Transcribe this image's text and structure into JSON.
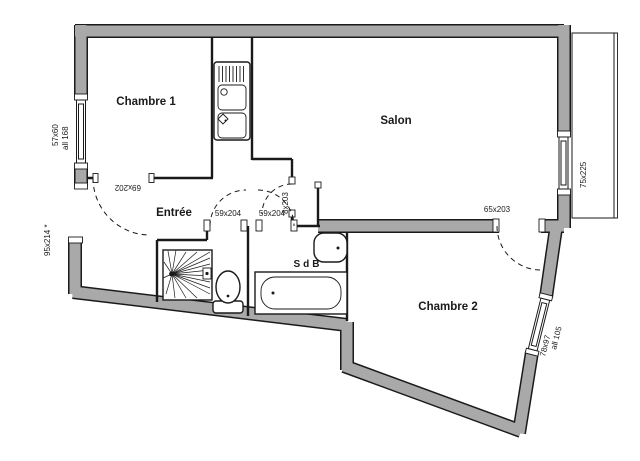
{
  "type": "floor-plan",
  "rooms": {
    "chambre1": "Chambre 1",
    "salon": "Salon",
    "entree": "Entrée",
    "sdb": "SdB",
    "chambre2": "Chambre 2"
  },
  "labels": {
    "window_ch1": "57x60",
    "window_ch1_sill": "all 168",
    "entrance_door": "95x214 *",
    "door_ch1": "69x202",
    "door_wc": "59x204",
    "door_sdb": "59x204",
    "door_salon": "8x203",
    "door_ch2": "65x203",
    "window_salon": "75x225",
    "window_ch2": "78x97",
    "window_ch2_sill": "all 105"
  },
  "fixtures": [
    "kitchen-sink",
    "shower",
    "toilet",
    "bathtub",
    "washbasin",
    "balcony"
  ],
  "colors": {
    "wall_fill": "#a9a9a9",
    "line": "#1a1a1a",
    "background": "#ffffff"
  }
}
